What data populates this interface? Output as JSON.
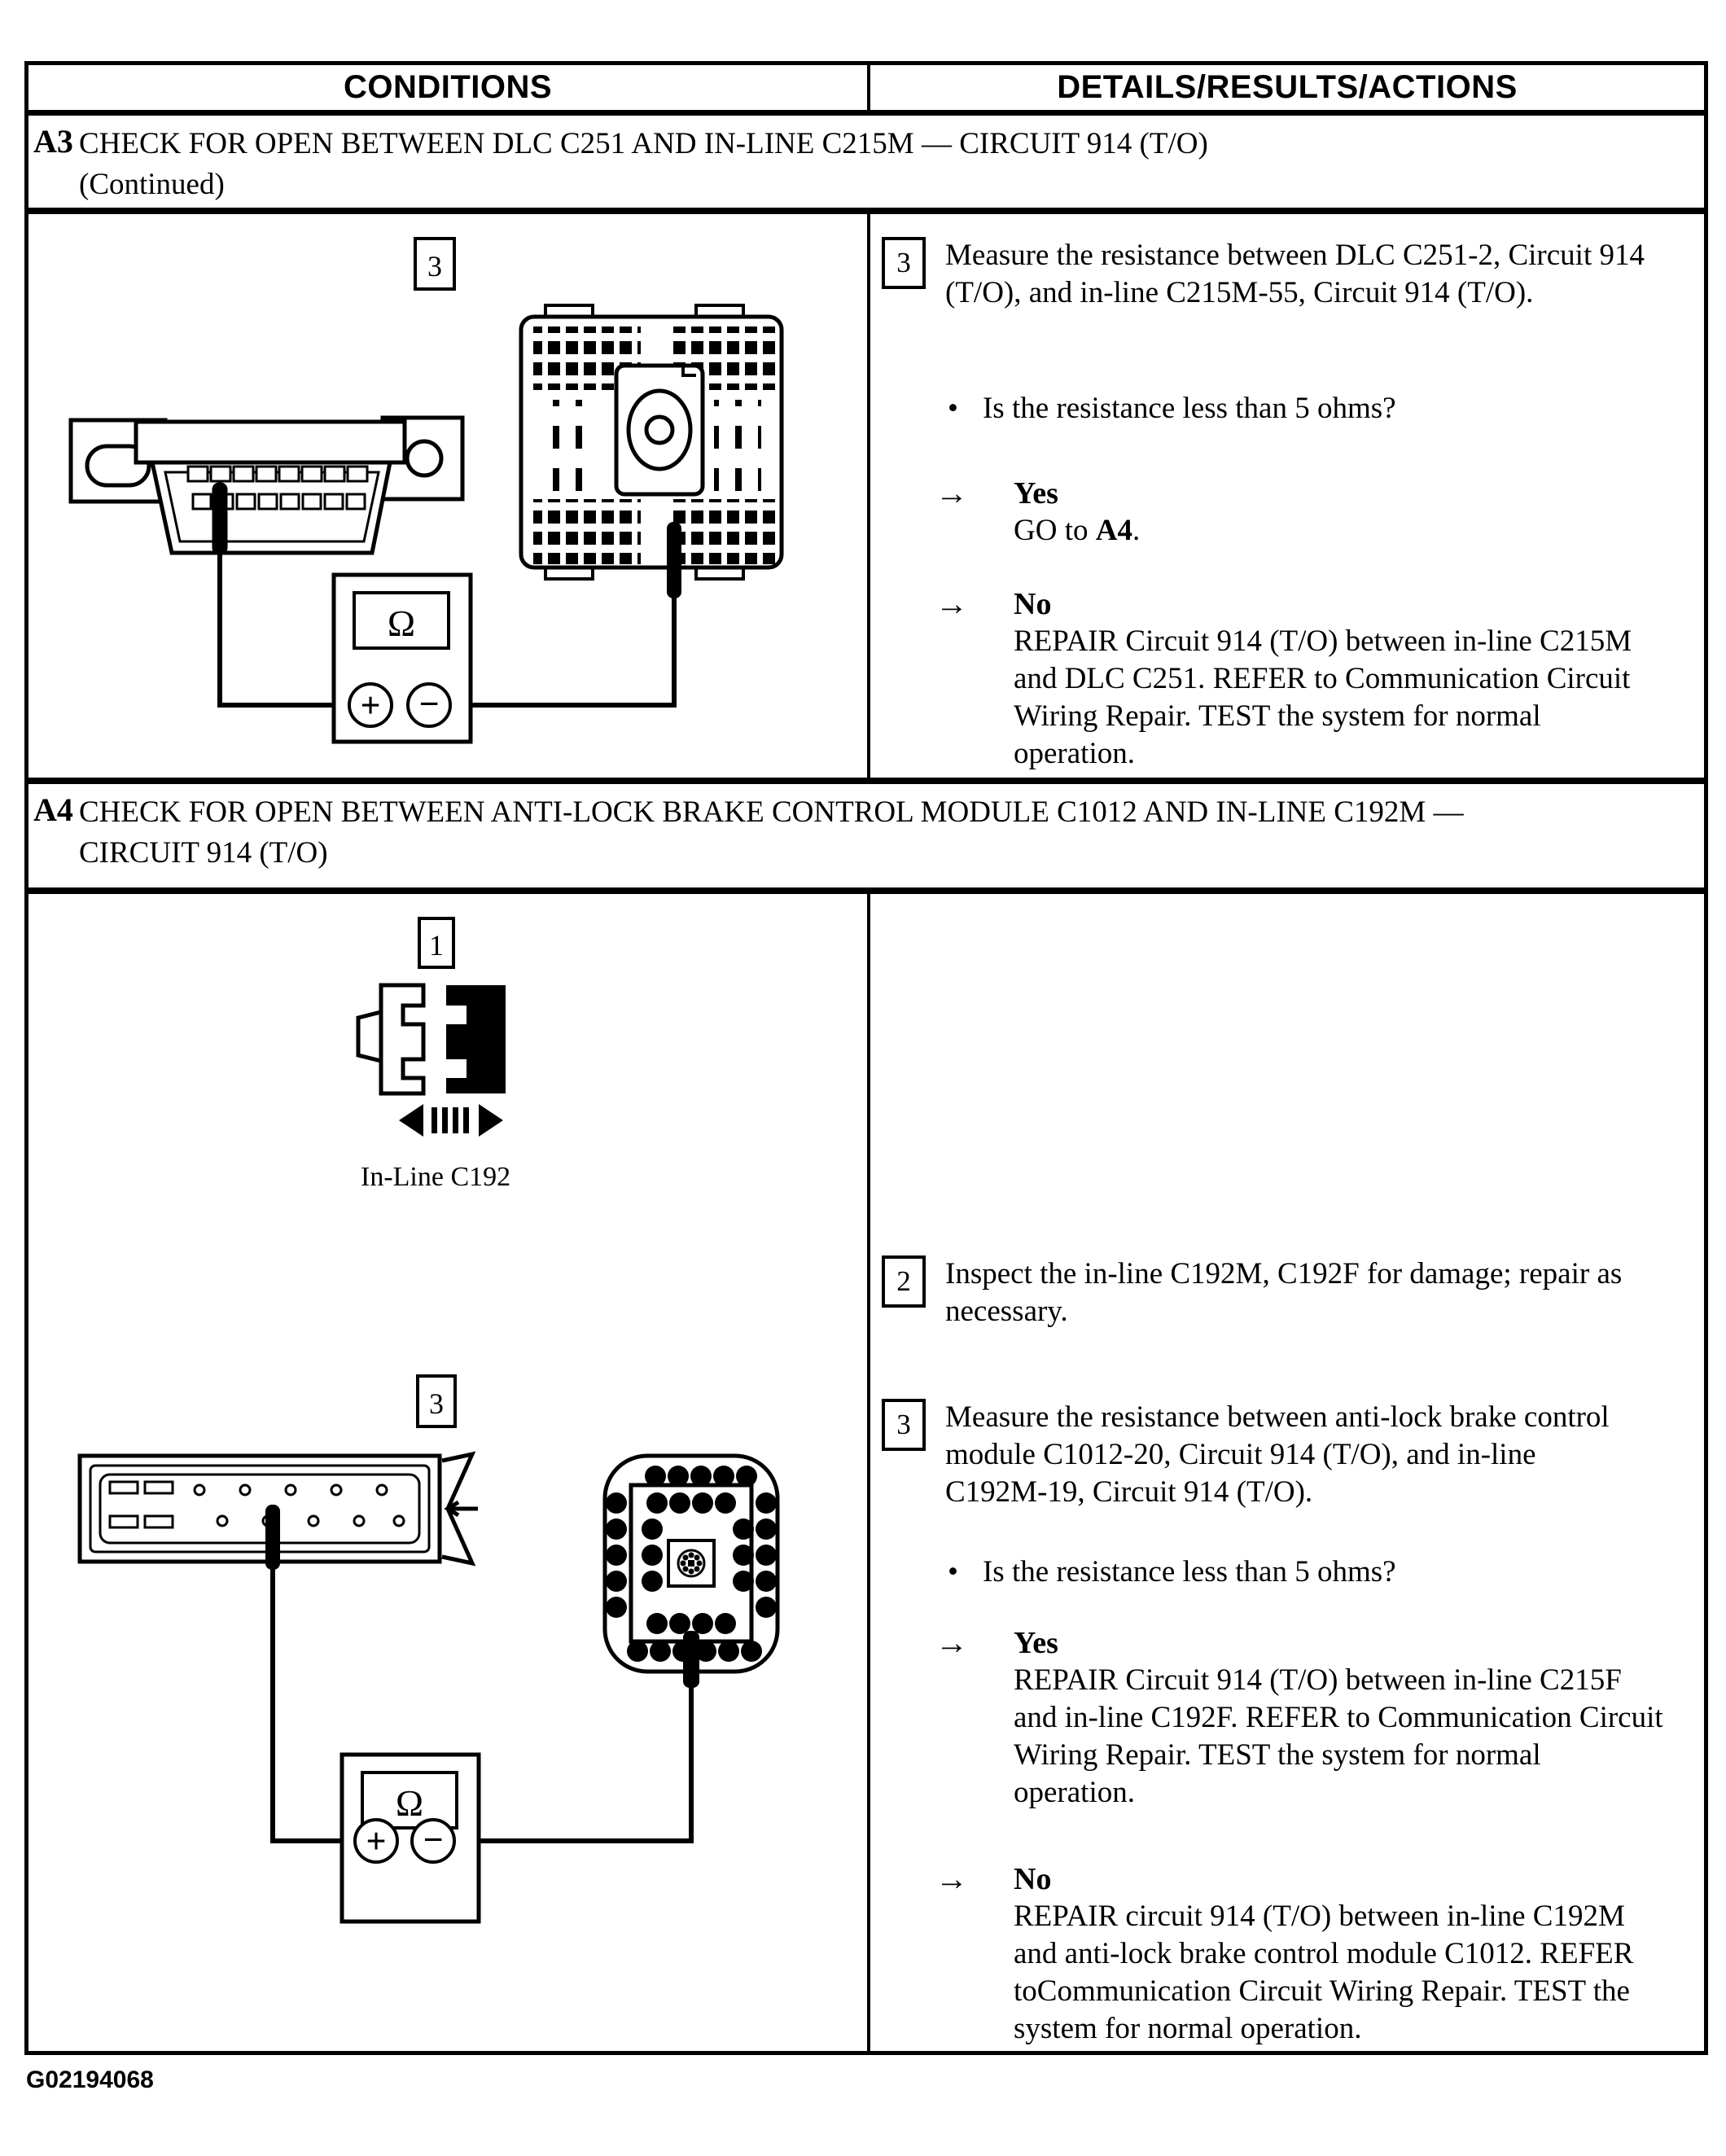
{
  "header": {
    "left": "CONDITIONS",
    "right": "DETAILS/RESULTS/ACTIONS"
  },
  "a3": {
    "label": "A3",
    "title": "CHECK FOR OPEN BETWEEN DLC C251 AND IN-LINE C215M — CIRCUIT 914 (T/O)",
    "continued": "(Continued)",
    "diagram": {
      "step_marker": "3",
      "meter": {
        "ohm": "Ω",
        "plus": "+",
        "minus": "−"
      }
    },
    "steps": [
      {
        "num": "3",
        "text": "Measure the resistance between DLC C251-2, Circuit 914 (T/O), and in-line C215M-55, Circuit 914 (T/O)."
      }
    ],
    "question": "Is the resistance less than 5 ohms?",
    "yes": {
      "label": "Yes",
      "action_prefix": "GO to ",
      "action_link": "A4",
      "action_suffix": "."
    },
    "no": {
      "label": "No",
      "action": "REPAIR Circuit 914 (T/O) between in-line C215M and DLC C251. REFER to Communication Circuit Wiring Repair. TEST the system for normal operation."
    }
  },
  "a4": {
    "label": "A4",
    "title": "CHECK FOR OPEN BETWEEN ANTI-LOCK BRAKE CONTROL MODULE C1012 AND IN-LINE C192M — CIRCUIT 914 (T/O)",
    "diagram1": {
      "step_marker": "1",
      "caption": "In-Line C192"
    },
    "diagram3": {
      "step_marker": "3",
      "meter": {
        "ohm": "Ω",
        "plus": "+",
        "minus": "−"
      }
    },
    "steps": [
      {
        "num": "2",
        "text": "Inspect the in-line C192M, C192F for damage; repair as necessary."
      },
      {
        "num": "3",
        "text": "Measure the resistance between anti-lock brake control module C1012-20, Circuit 914 (T/O), and in-line C192M-19, Circuit 914 (T/O)."
      }
    ],
    "question": "Is the resistance less than 5 ohms?",
    "yes": {
      "label": "Yes",
      "action": "REPAIR Circuit 914 (T/O) between in-line C215F and in-line C192F. REFER to Communication Circuit Wiring Repair. TEST the system for normal operation."
    },
    "no": {
      "label": "No",
      "action": "REPAIR circuit 914 (T/O) between in-line C192M and anti-lock brake control module C1012. REFER toCommunication Circuit Wiring Repair. TEST the system for normal operation."
    }
  },
  "glyphs": {
    "arrow": "→",
    "bullet": "•"
  },
  "footer": {
    "figure_id": "G02194068"
  }
}
